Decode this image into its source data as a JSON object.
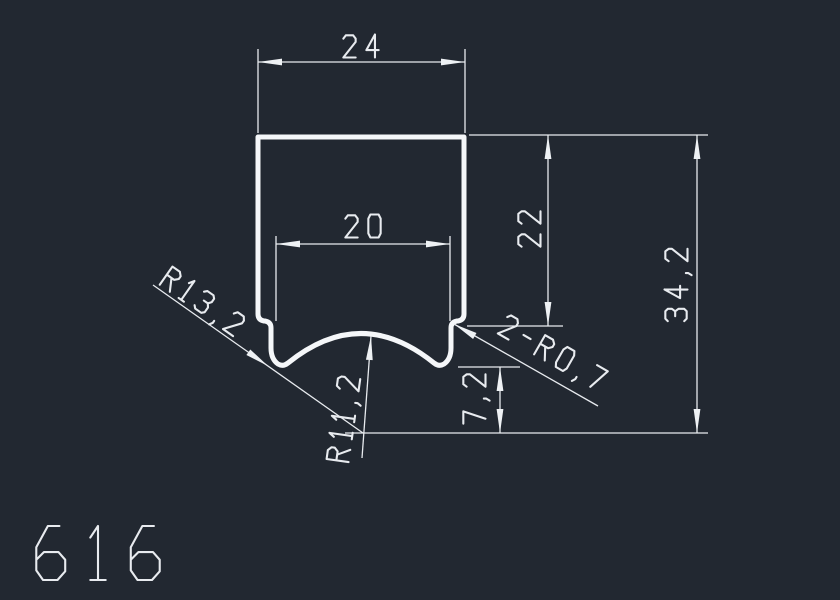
{
  "app": {
    "type": "cad-drawing-canvas",
    "background_color": "#222831",
    "line_color": "#e8ebef",
    "profile_line_color": "#f5f7f9",
    "drawing_number": "616"
  },
  "drawing": {
    "profile": {
      "name": "profile-outline",
      "path": "M 258,137 L 464,137 L 464,314 Q 464,320 458,321 L 457,321 Q 451,322 451,328 L 451,348 Q 451,359 444,364 Q 439,367 434,363 Q 361,304 288,363 Q 283,367 278,364 Q 271,359 271,348 L 271,328 Q 271,322 265,321 L 264,321 Q 258,320 258,314 Z"
    },
    "dimensions": [
      {
        "name": "dim-width-24",
        "label": "24",
        "text": {
          "pos": [
            361,
            46
          ],
          "rot": 0,
          "size": 23
        },
        "lines": [
          [
            258,
            49,
            258,
            133
          ],
          [
            465,
            49,
            465,
            133
          ],
          [
            258,
            62,
            465,
            62
          ]
        ],
        "arrows": [
          [
            258,
            62,
            180
          ],
          [
            465,
            62,
            0
          ]
        ]
      },
      {
        "name": "dim-width-20",
        "label": "20",
        "text": {
          "pos": [
            363,
            226
          ],
          "rot": 0,
          "size": 23
        },
        "lines": [
          [
            276,
            236,
            276,
            321
          ],
          [
            450,
            236,
            450,
            321
          ],
          [
            276,
            244,
            450,
            244
          ]
        ],
        "arrows": [
          [
            276,
            244,
            180
          ],
          [
            450,
            244,
            0
          ]
        ]
      },
      {
        "name": "dim-height-22",
        "label": "22",
        "text": {
          "pos": [
            529,
            229
          ],
          "rot": -90,
          "size": 23
        },
        "lines": [
          [
            469,
            135,
            708,
            135
          ],
          [
            467,
            326,
            563,
            326
          ],
          [
            548,
            135,
            548,
            326
          ]
        ],
        "arrows": [
          [
            548,
            135,
            -90
          ],
          [
            548,
            326,
            90
          ]
        ]
      },
      {
        "name": "dim-height-34-2",
        "label": "34,2",
        "text": {
          "pos": [
            676,
            285
          ],
          "rot": -90,
          "size": 23
        },
        "lines": [
          [
            345,
            433,
            708,
            433
          ],
          [
            697,
            135,
            697,
            433
          ]
        ],
        "arrows": [
          [
            697,
            135,
            -90
          ],
          [
            697,
            433,
            90
          ]
        ]
      },
      {
        "name": "dim-height-7-2",
        "label": "7,2",
        "text": {
          "pos": [
            474,
            399
          ],
          "rot": -90,
          "size": 23
        },
        "lines": [
          [
            458,
            367,
            520,
            367
          ],
          [
            500,
            367,
            500,
            433
          ]
        ],
        "arrows": [
          [
            500,
            367,
            -90
          ],
          [
            500,
            433,
            90
          ]
        ]
      }
    ],
    "leaders": [
      {
        "name": "leader-radius-R13-2",
        "label": "R13,2",
        "text": {
          "pos": [
            203,
            301
          ],
          "rot": 35,
          "size": 23
        },
        "lines": [
          [
            153,
            285,
            363,
            433
          ]
        ],
        "arrows": [
          [
            268,
            366,
            35
          ]
        ]
      },
      {
        "name": "leader-radius-R11-2",
        "label": "R11,2",
        "text": {
          "pos": [
            343,
            419
          ],
          "rot": -82,
          "size": 23
        },
        "lines": [
          [
            371,
            336,
            362,
            458
          ]
        ],
        "arrows": [
          [
            371,
            336,
            -86
          ]
        ]
      },
      {
        "name": "leader-fillet-2-R0-7",
        "label": "2-R0,7",
        "text": {
          "pos": [
            553,
            352
          ],
          "rot": 30,
          "size": 23
        },
        "lines": [
          [
            454,
            324,
            598,
            406
          ]
        ],
        "arrows": [
          [
            454,
            324,
            210
          ]
        ]
      }
    ],
    "title_block": {
      "name": "drawing-number",
      "label": "616",
      "text": {
        "pos": [
          98,
          553
        ],
        "rot": 0,
        "size": 54
      }
    }
  }
}
